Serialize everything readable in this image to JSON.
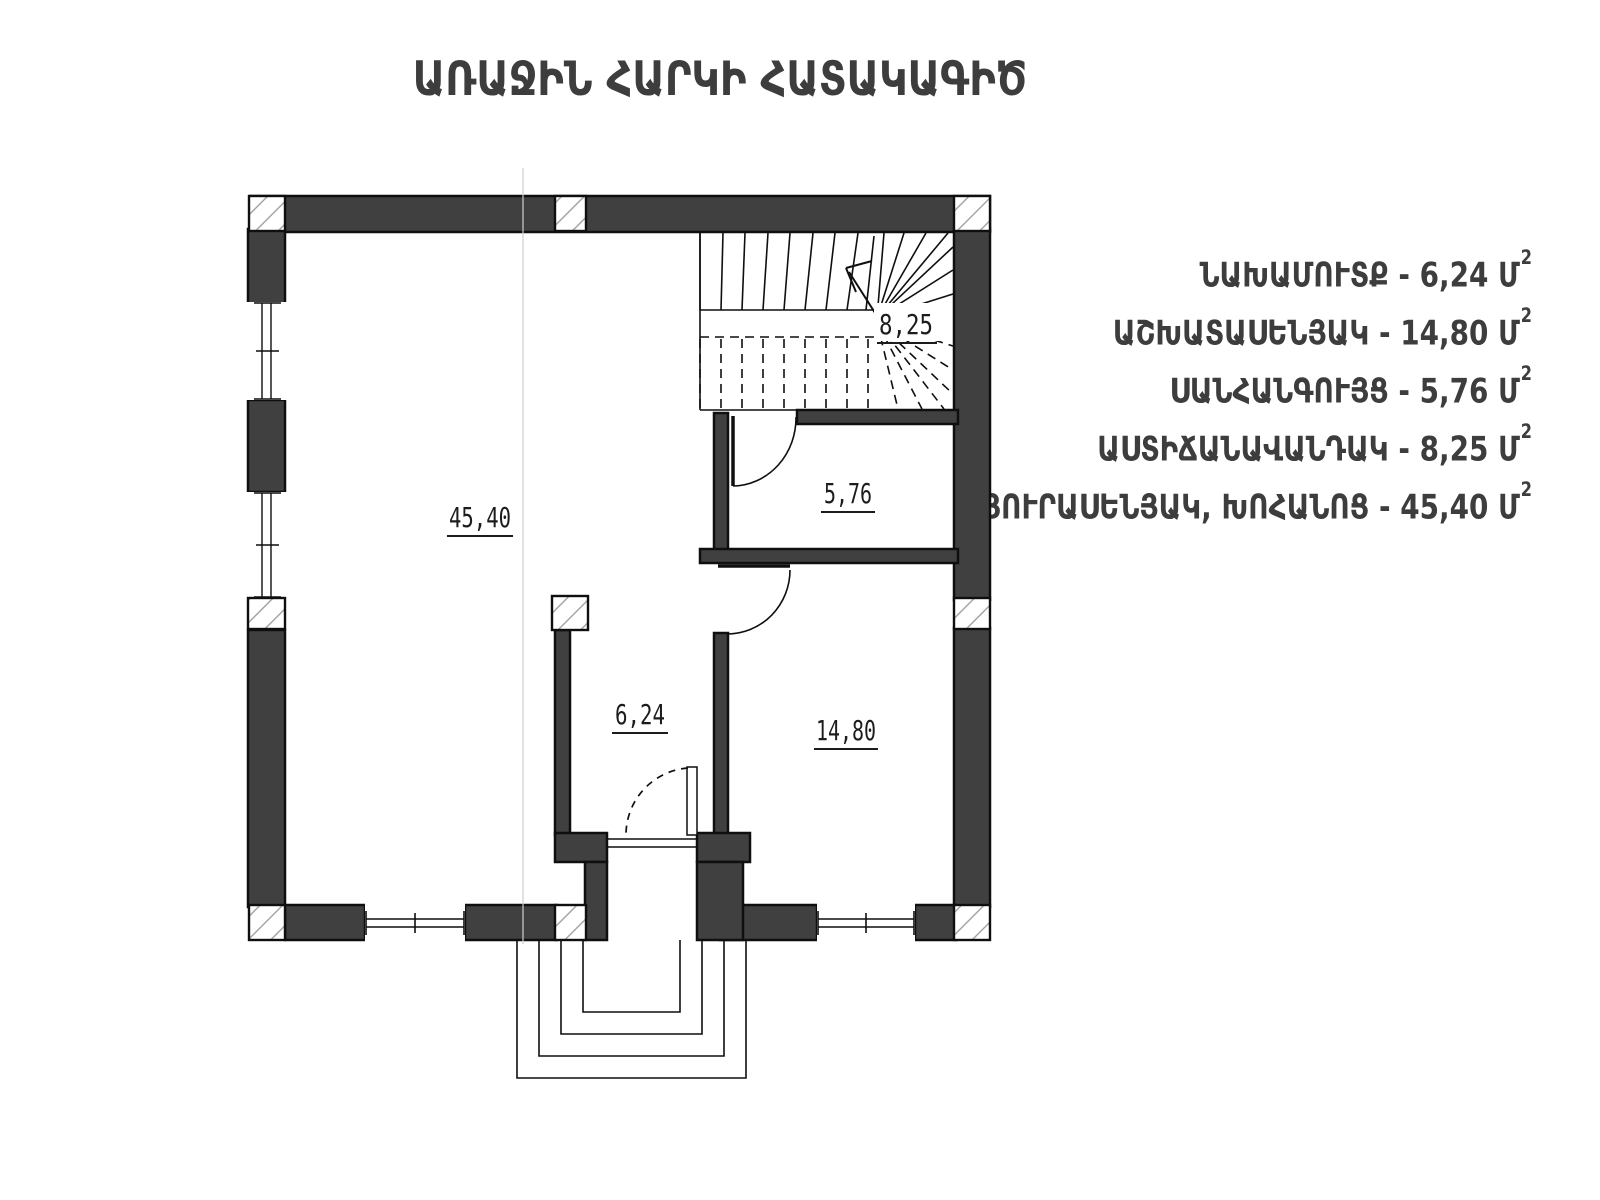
{
  "title": "ԱՌԱՋԻՆ ՀԱՐԿԻ ՀԱՏԱԿԱԳԻԾ",
  "legend": {
    "items": [
      {
        "text": "ՆԱԽԱՄՈՒՏՔ - 6,24 Մ",
        "sup": "2"
      },
      {
        "text": "ԱՇԽԱՏԱՍԵՆՅԱԿ - 14,80 Մ",
        "sup": "2"
      },
      {
        "text": "ՍԱՆՀԱՆԳՈՒՅՑ - 5,76 Մ",
        "sup": "2"
      },
      {
        "text": "ԱՍՏԻՃԱՆԱՎԱՆԴԱԿ - 8,25 Մ",
        "sup": "2"
      },
      {
        "text": "ՀՅՈՒՐԱՍԵՆՅԱԿ, ԽՈՀԱՆՈՑ - 45,40 Մ",
        "sup": "2"
      }
    ]
  },
  "plan": {
    "room_labels": {
      "living_kitchen": "45,40",
      "bathroom": "5,76",
      "entrance_hall": "6,24",
      "workroom": "14,80",
      "staircase": "8,25"
    }
  },
  "colors": {
    "wall": "#404040",
    "line": "#0f0f0f",
    "text": "#3d3d3d"
  }
}
